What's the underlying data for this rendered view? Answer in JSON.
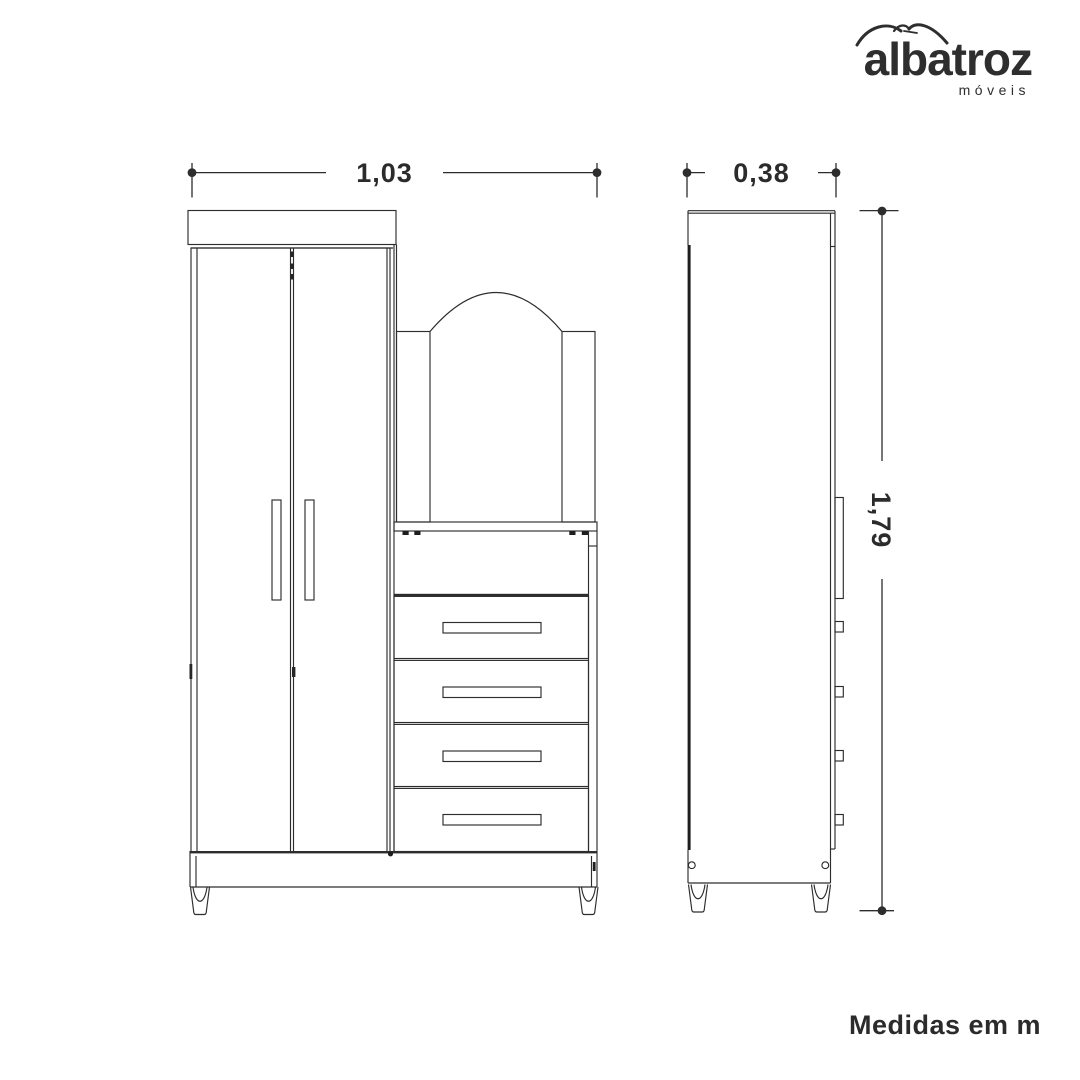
{
  "logo": {
    "brand": "albatroz",
    "subtitle": "móveis",
    "icon": "albatross-swoosh-icon"
  },
  "dimensions": {
    "front_width": "1,03",
    "side_depth": "0,38",
    "height": "1,79"
  },
  "footer": {
    "note": "Medidas em m"
  },
  "diagram": {
    "views": [
      "front-view",
      "side-view"
    ],
    "drawer_count": 4,
    "door_count": 2
  },
  "colors": {
    "line": "#2d2d2d",
    "text": "#2b2b2b",
    "background": "#ffffff"
  }
}
